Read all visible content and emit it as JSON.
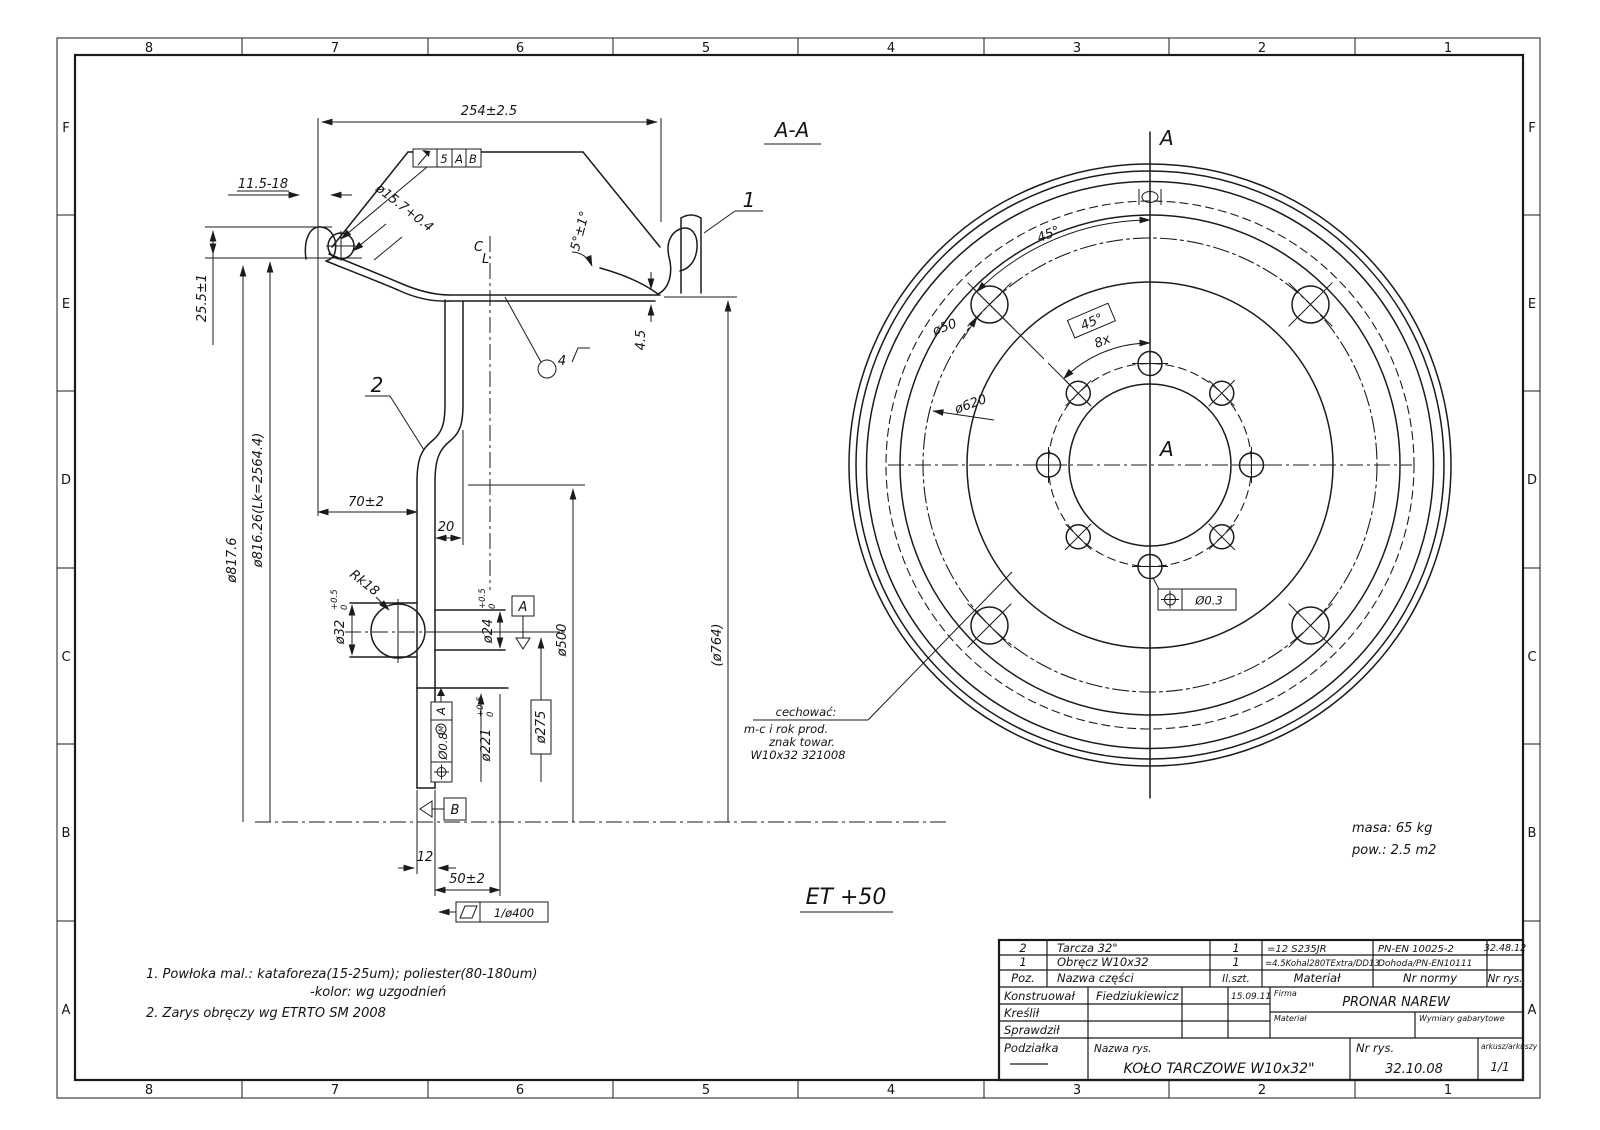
{
  "sheet": {
    "zones_h": [
      "8",
      "7",
      "6",
      "5",
      "4",
      "3",
      "2",
      "1"
    ],
    "zones_v": [
      "F",
      "E",
      "D",
      "C",
      "B",
      "A"
    ]
  },
  "notes": {
    "n1a": "1. Powłoka mal.:  kataforeza(15-25um);  poliester(80-180um)",
    "n1b": "-kolor:  wg uzgodnień",
    "n2": "2. Zarys obręczy wg ETRTO SM 2008"
  },
  "annotations": {
    "mass": "masa:  65 kg",
    "area": "pow.: 2.5 m2",
    "offset": "ET +50"
  },
  "section_view": {
    "title": "A-A",
    "cl_c": "C",
    "cl_l": "L",
    "callout_rim": "1",
    "callout_disc": "2",
    "surface": "4",
    "weld": {
      "size": "5",
      "a": "A",
      "b": "B"
    },
    "dims": {
      "rim_width": "254±2.5",
      "flange_width": "11.5-18",
      "flange_height": "25.5±1",
      "gutter_dia": "ø15.7+0.4",
      "seat_angle": "5°±1°",
      "rim_od": "ø817.6",
      "bead_dia": "ø816.26(Lk=2564.4)",
      "disc_offset": "70±2",
      "vent_offset": "20",
      "wall": "4.5",
      "ball_radius": "Rk18",
      "hole_outer": "ø32",
      "hole_outer_tol_u": "+0.5",
      "hole_outer_tol_l": "0",
      "hole_inner": "ø24",
      "hole_inner_tol_u": "+0.5",
      "hole_inner_tol_l": "0",
      "hub_bore": "ø221",
      "hub_bore_tol_u": "+0.5",
      "hub_bore_tol_l": "0",
      "bolt_circle": "ø275",
      "seat_dia": "ø500",
      "ref_dia": "(ø764)",
      "disc_thk": "12",
      "hub_offset": "50±2",
      "flatness": "1/ø400",
      "position": "Ø0.8",
      "position_mod": "M",
      "datum_a": "A",
      "datum_b": "B",
      "datum_ref": "A"
    }
  },
  "front_view": {
    "section_a_top": "A",
    "section_a_mid": "A",
    "vent_angle": "45°",
    "bolt_angle": "45°",
    "bolt_count": "8x",
    "vent_dia": "ø50",
    "vent_circle_dia": "ø620",
    "position_tol": "Ø0.3",
    "marking": {
      "l1": "cechować:",
      "l2": "m-c i rok prod.",
      "l3": "znak towar.",
      "l4": "W10x32   321008"
    }
  },
  "title_block": {
    "parts": [
      {
        "poz": "2",
        "name": "Tarcza 32\"",
        "qty": "1",
        "material": "=12 S235JR",
        "standard": "PN-EN 10025-2",
        "drawing_no": "32.48.12"
      },
      {
        "poz": "1",
        "name": "Obręcz W10x32",
        "qty": "1",
        "material": "=4.5Kohal280TExtra/DD13",
        "standard": "Dohoda/PN-EN10111",
        "drawing_no": ""
      }
    ],
    "headers": {
      "poz": "Poz.",
      "name": "Nazwa części",
      "qty": "Il.szt.",
      "material": "Materiał",
      "standard": "Nr normy",
      "drawing_no": "Nr rys."
    },
    "roles": {
      "designed": "Konstruował",
      "drawn": "Kreślił",
      "checked": "Sprawdził",
      "designer_name": "Fiedziukiewicz",
      "date": "15.09.11"
    },
    "firm_label": "Firma",
    "firm": "PRONAR NAREW",
    "material_label": "Materiał",
    "dimensions_label": "Wymiary gabarytowe",
    "scale_label": "Podziałka",
    "title_label": "Nazwa rys.",
    "title": "KOŁO TARCZOWE W10x32\"",
    "number_label": "Nr rys.",
    "number": "32.10.08",
    "sheet_label": "arkusz/arkuszy",
    "sheet": "1/1"
  }
}
